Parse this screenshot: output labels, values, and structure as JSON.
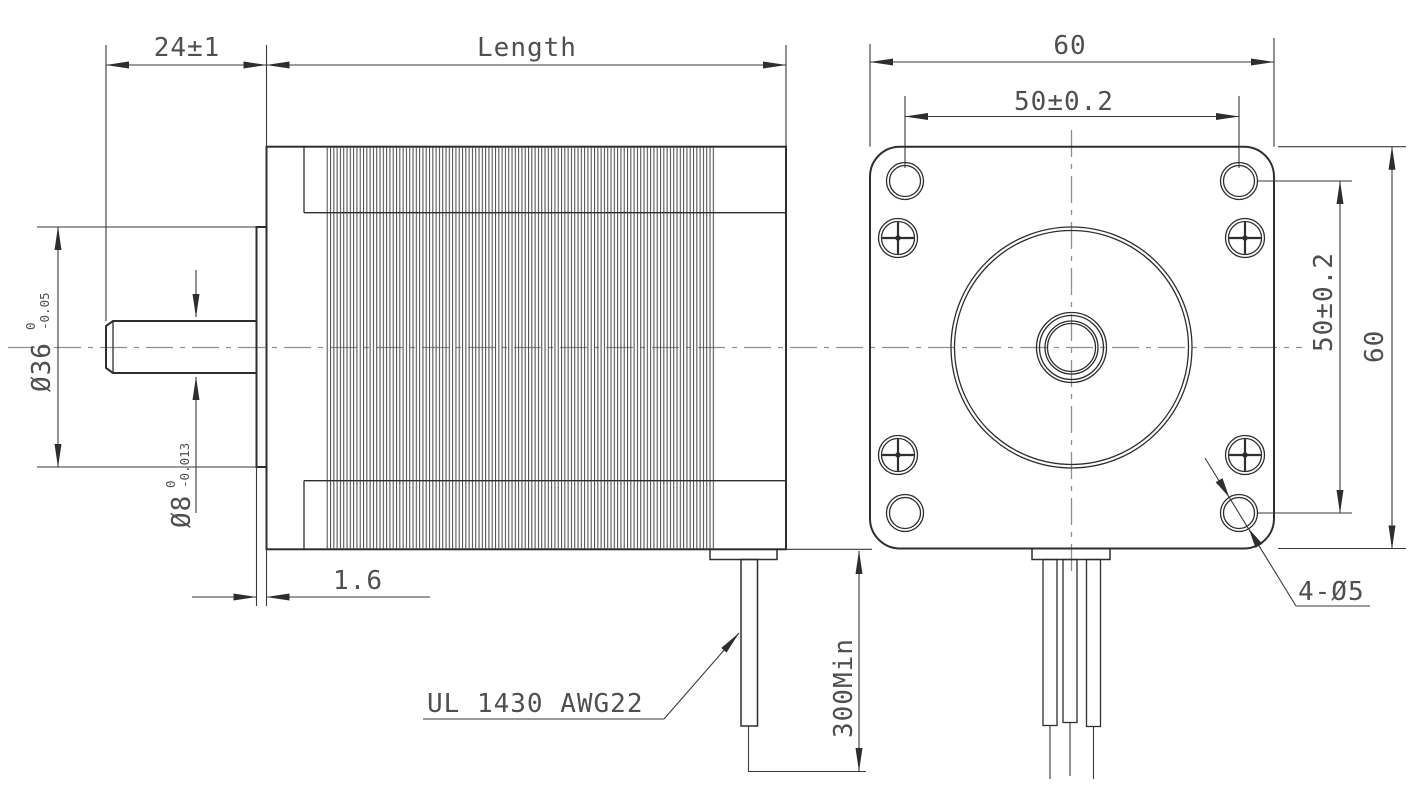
{
  "drawing": {
    "type": "stepper-motor-dimension-drawing",
    "colors": {
      "background": "#ffffff",
      "line": "#2e2e2e",
      "thin_line": "#3a3a3a",
      "centerline": "#8f8f8f",
      "text": "#4f4f4f"
    },
    "side_view": {
      "dim_shaft_ext": "24±1",
      "dim_length": "Length",
      "boss_dia": "Ø36",
      "boss_tol_upper": "0",
      "boss_tol_lower": "-0.05",
      "shaft_dia": "Ø8",
      "shaft_tol_upper": "0",
      "shaft_tol_lower": "-0.013",
      "dim_boss_depth": "1.6",
      "lead_spec": "UL 1430 AWG22",
      "dim_lead_length": "300Min"
    },
    "front_view": {
      "dim_width": "60",
      "dim_hole_pitch_h": "50±0.2",
      "dim_hole_pitch_v": "50±0.2",
      "dim_height": "60",
      "dim_mount_holes": "4-Ø5"
    }
  }
}
